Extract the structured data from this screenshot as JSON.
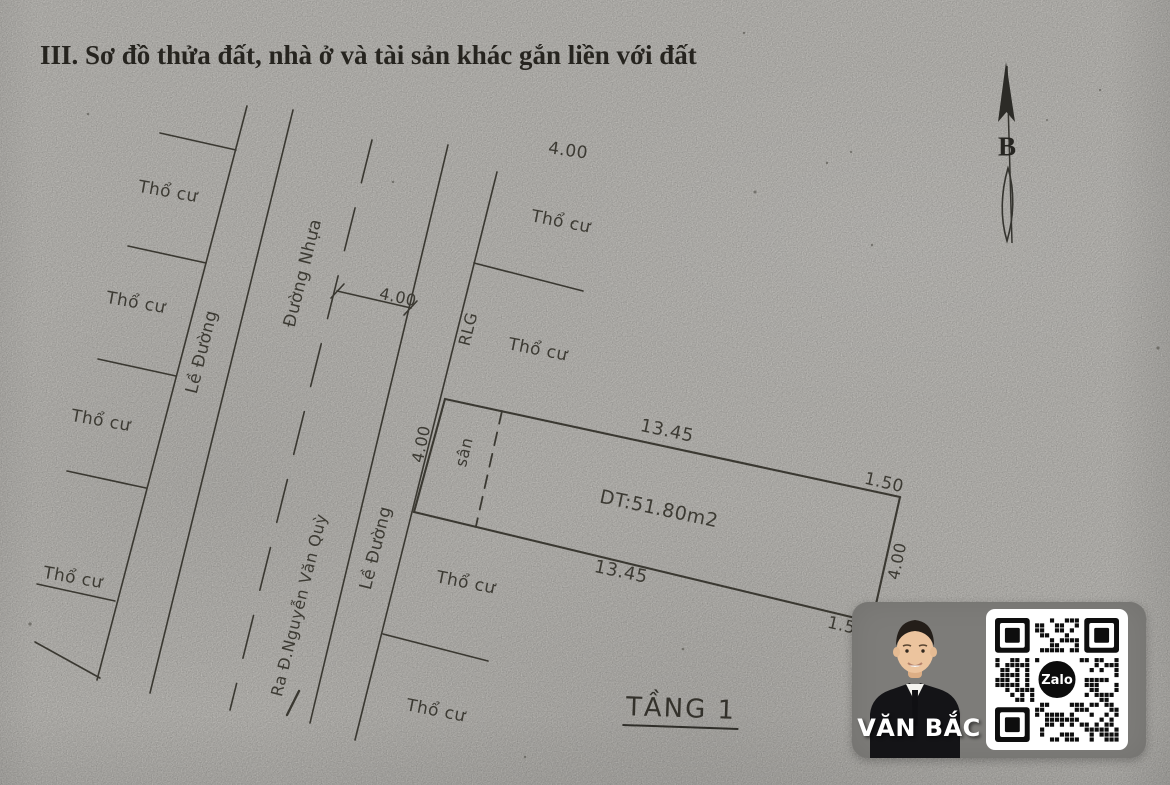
{
  "document": {
    "section_title": "III. Sơ đồ thửa đất, nhà ở và tài sản khác gắn liền với đất"
  },
  "compass": {
    "north_label": "B"
  },
  "diagram": {
    "floor_label": "TẦNG 1",
    "area_label": "DT:51.80m2",
    "land_use_label": "Thổ cư",
    "road_shoulder_label": "Lề Đường",
    "asphalt_road_label": "Đường Nhựa",
    "road_exit_label": "Ra Đ.Nguyễn Văn Quỳ",
    "road_boundary_label": "RLG",
    "yard_label": "sân",
    "dims": {
      "top_width": "4.00",
      "road_half_width": "4.00",
      "frontage_width": "4.00",
      "rear_width": "4.00",
      "top_length": "13.45",
      "bottom_length": "13.45",
      "top_corner": "1.50",
      "bottom_corner": "1.50"
    }
  },
  "badge": {
    "agent_name": "VĂN BẮC",
    "qr_logo_label": "Zalo"
  },
  "colors": {
    "paper": "#d9d7d2",
    "ink": "#3a3831",
    "badge_bg": "#7d7c79",
    "suit": "#141417",
    "skin": "#ecc49e"
  }
}
